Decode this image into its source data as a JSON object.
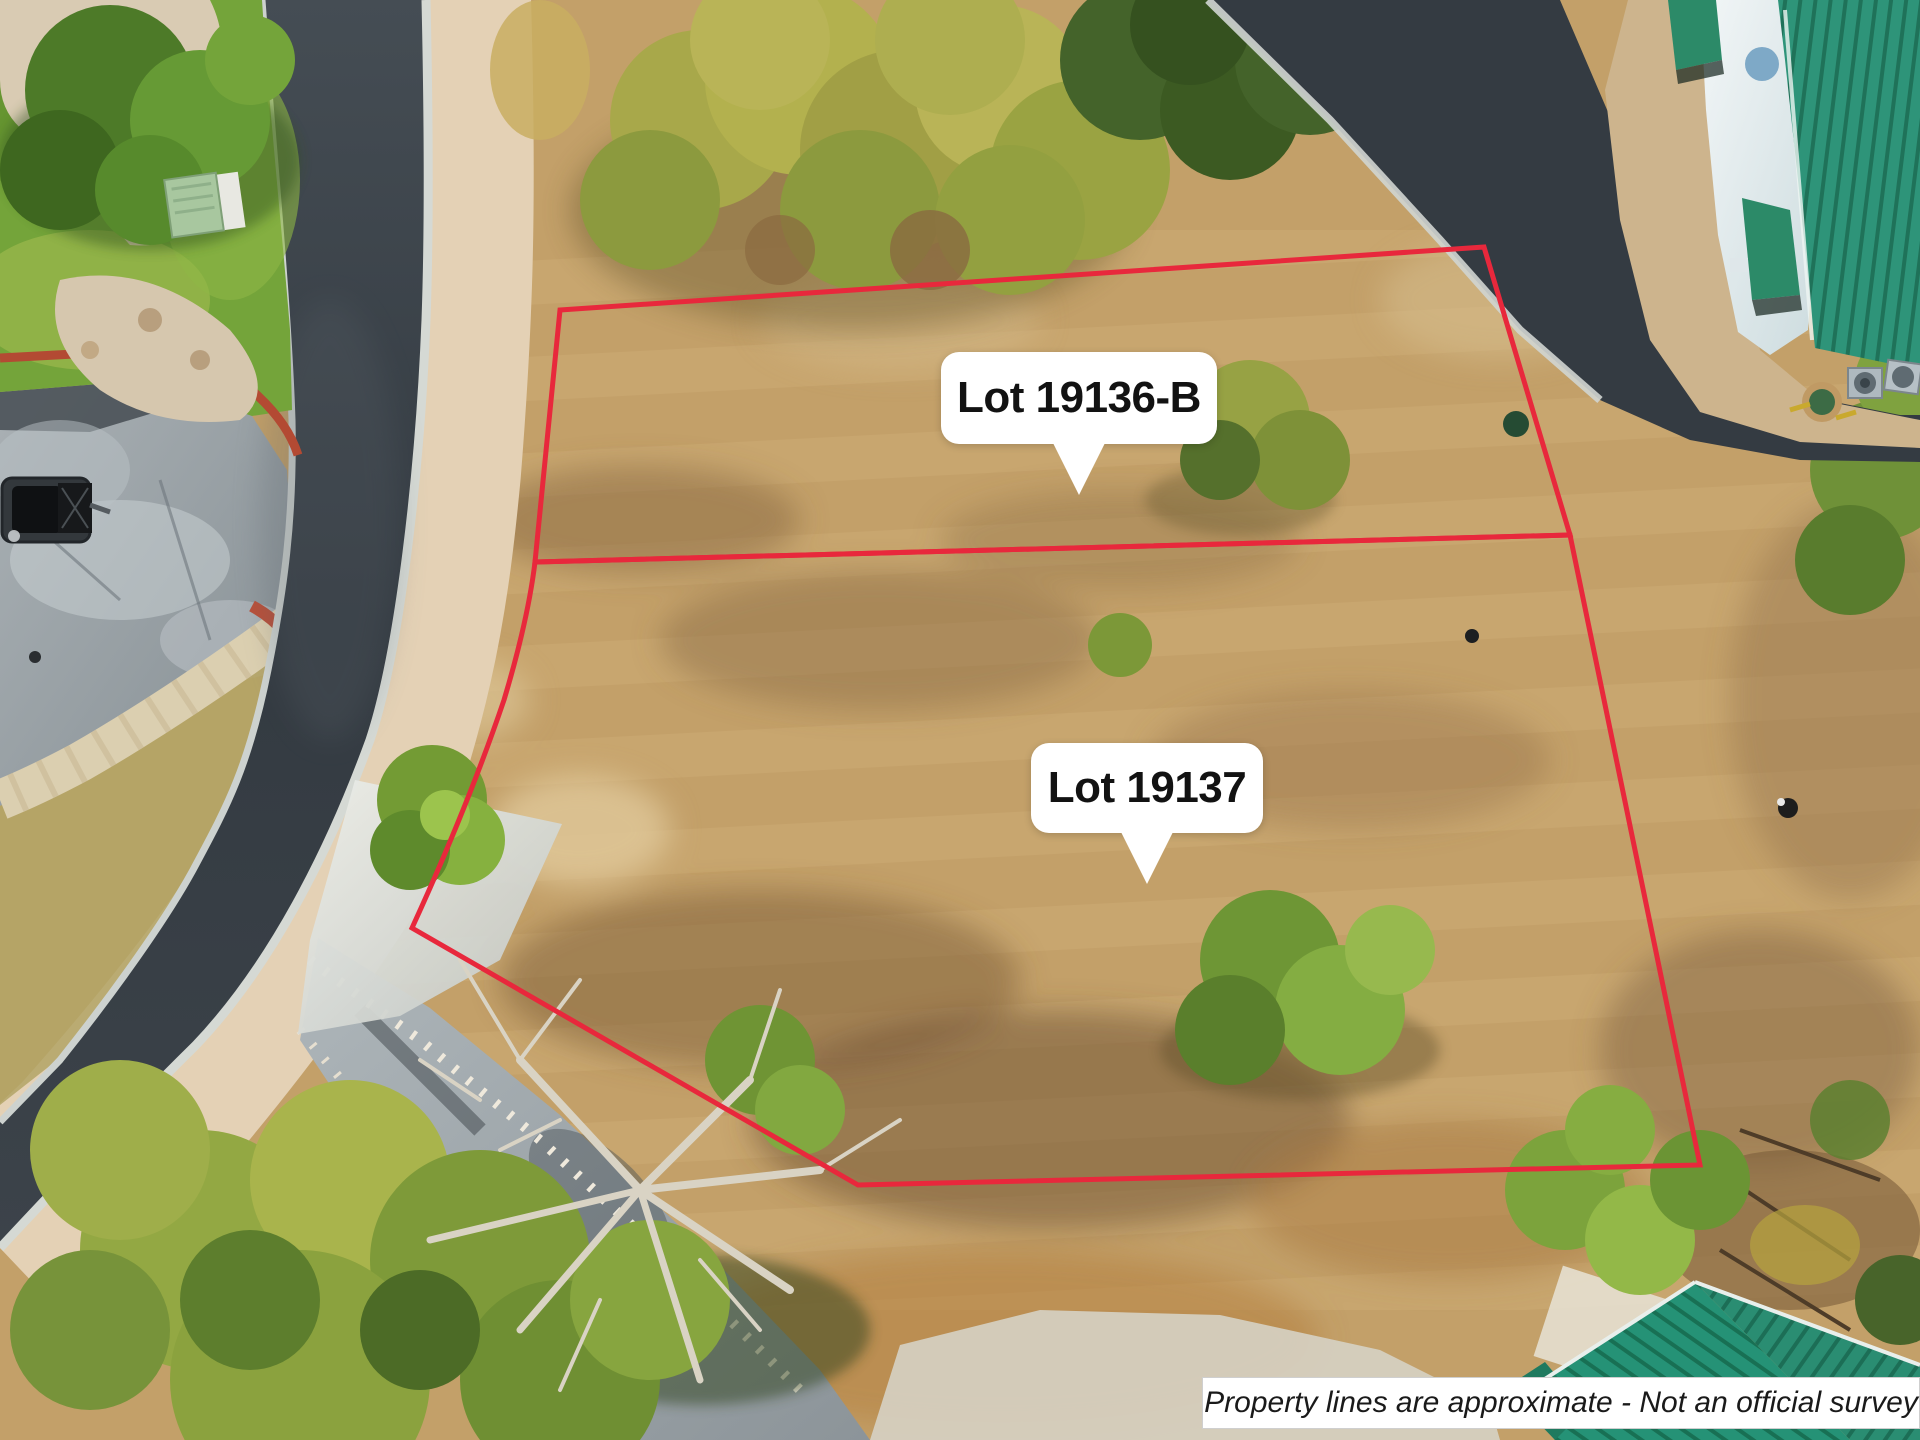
{
  "annotations": {
    "lots": [
      {
        "label": "Lot 19136-B"
      },
      {
        "label": "Lot 19137"
      }
    ],
    "disclaimer": "Property lines are approximate - Not an official survey"
  },
  "colors": {
    "property_line": "#e8283c",
    "label_background": "#ffffff",
    "label_text": "#121212",
    "disclaimer_text": "#1a1a1a",
    "field_tan": "#c3a069",
    "dry_grass_light": "#dfc08b",
    "dirt_brown": "#8a6a44",
    "road_asphalt": "#363d44",
    "old_asphalt_gray": "#9aa2a6",
    "lawn_green": "#74a43a",
    "tree_olive": "#a8a84a",
    "tree_green": "#4e7429",
    "metal_roof_green": "#2e9479",
    "gravel_tan": "#e4d1b5",
    "concrete_light": "#d9dcd6",
    "rock_white": "#efe9dc",
    "dead_branch": "#d9d3c4"
  }
}
